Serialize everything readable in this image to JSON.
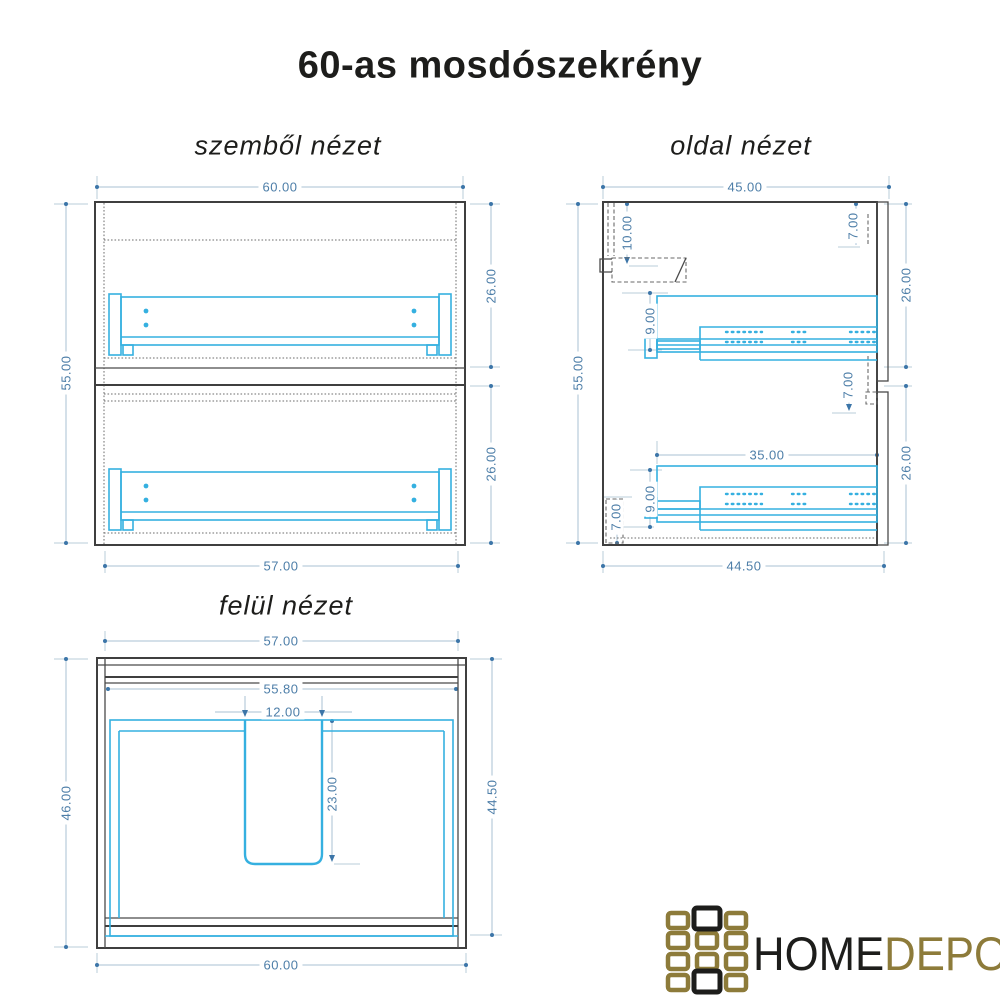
{
  "title": "60-as mosdószekrény",
  "views": {
    "front": {
      "label": "szemből nézet",
      "dims": {
        "width_top": "60.00",
        "height_left": "55.00",
        "drawer_upper_height": "26.00",
        "drawer_lower_height": "26.00",
        "width_bottom": "57.00"
      }
    },
    "side": {
      "label": "oldal nézet",
      "dims": {
        "depth_top": "45.00",
        "height_left": "55.00",
        "back_offset": "10.00",
        "front_top_gap": "7.00",
        "front_upper_height": "26.00",
        "rail_upper_offset": "9.00",
        "front_mid_gap": "7.00",
        "rail_length": "35.00",
        "front_lower_height": "26.00",
        "rail_lower_offset": "9.00",
        "plinth_height": "7.00",
        "depth_bottom": "44.50"
      }
    },
    "top": {
      "label": "felül nézet",
      "dims": {
        "width_top": "57.00",
        "width_inner": "55.80",
        "cutout_width": "12.00",
        "depth_left": "46.00",
        "cutout_depth": "23.00",
        "depth_right": "44.50",
        "width_bottom": "60.00"
      }
    }
  },
  "logo": {
    "text_primary": "HOME",
    "text_secondary": "DEPO"
  },
  "colors": {
    "drawing_cyan": "#35b0e0",
    "dimension_blue": "#4d7ea8",
    "line_dark": "#3f3f3f",
    "logo_gold": "#8d7b3a",
    "logo_black": "#1d1d1b"
  }
}
